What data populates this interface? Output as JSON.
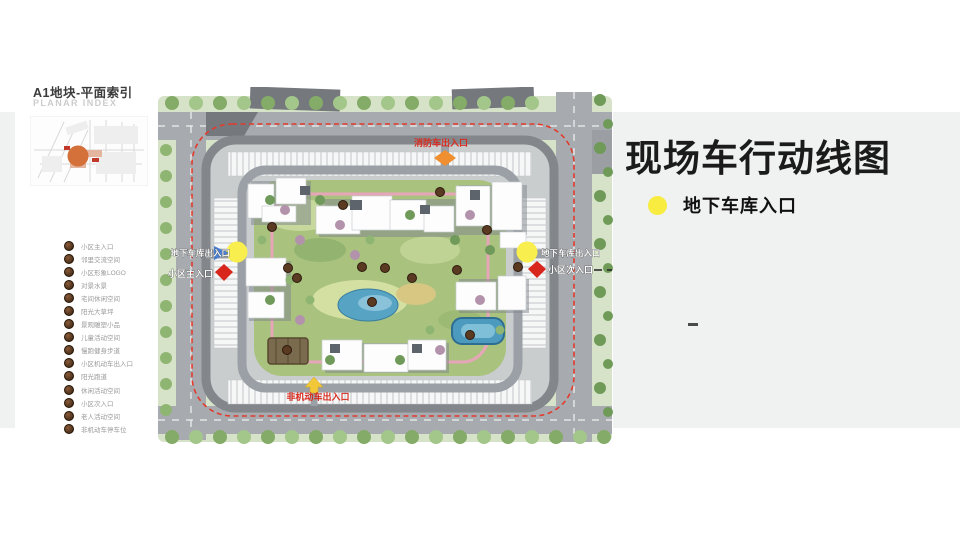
{
  "right": {
    "title": "现场车行动线图",
    "legend_label": "地下车库入口",
    "note_dash": "-"
  },
  "panel": {
    "title": "A1地块-平面索引",
    "subtitle": "PLANAR INDEX",
    "legend_items": [
      "小区主入口",
      "邻里交流空间",
      "小区形象LOGO",
      "对景水景",
      "宅间休闲空间",
      "阳光大草坪",
      "景观雕塑小品",
      "儿童活动空间",
      "慢跑健身步道",
      "小区机动车出入口",
      "阳光跑道",
      "休闲活动空间",
      "小区次入口",
      "老人活动空间",
      "非机动车停车位"
    ]
  },
  "plan": {
    "labels": {
      "fire_entrance": "消防车出入口",
      "garage_left": "地下车库出入口",
      "garage_right": "地下车库出入口",
      "main_entrance": "小区主入口",
      "secondary_entrance": "小区次入口",
      "non_motor_entrance": "非机动车出入口"
    },
    "colors": {
      "garage_marker": "#F8EE4E",
      "fire_route_dash": "#E23B2E",
      "entrance_arrow": "#D9261C",
      "fire_arrow": "#EF8F2F",
      "non_motor_arrow": "#F3C838",
      "blue_arrow": "#4A7FD0",
      "road": "#A7ABAF",
      "courtyard_green": "#A9C37F",
      "water": "#57A3C4"
    }
  }
}
